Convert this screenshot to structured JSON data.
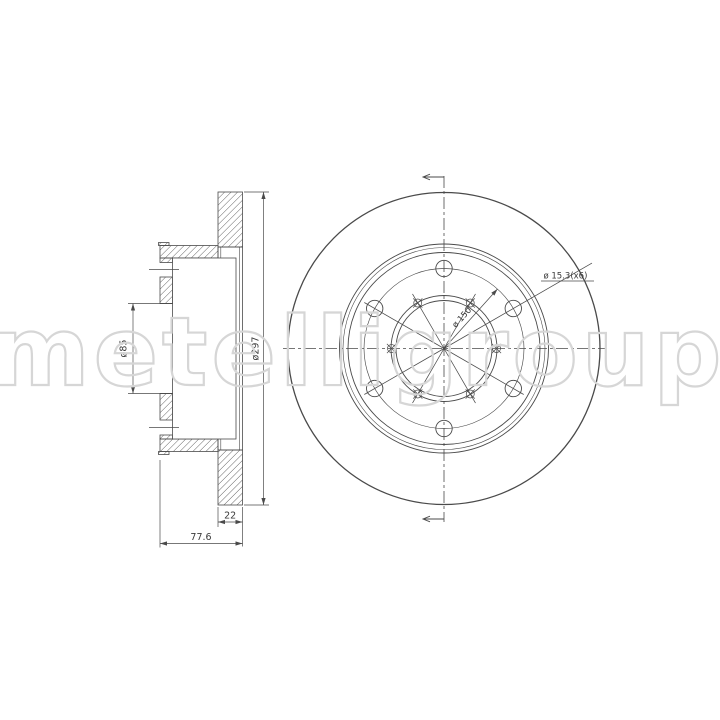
{
  "watermark": {
    "text": "metelligroup"
  },
  "section_view": {
    "bore_diameter_label": "ø85",
    "outer_diameter_label": "ø297",
    "thickness_label": "22",
    "overall_width_label": "77.6"
  },
  "front_view": {
    "bolt_hole_label": "ø 15.3(x6)",
    "bolt_circle_label": "ø 150"
  },
  "colors": {
    "line": "#4a4a4a",
    "dim_text": "#3a3a3a",
    "watermark": "#d6d6d6",
    "background": "#ffffff"
  }
}
